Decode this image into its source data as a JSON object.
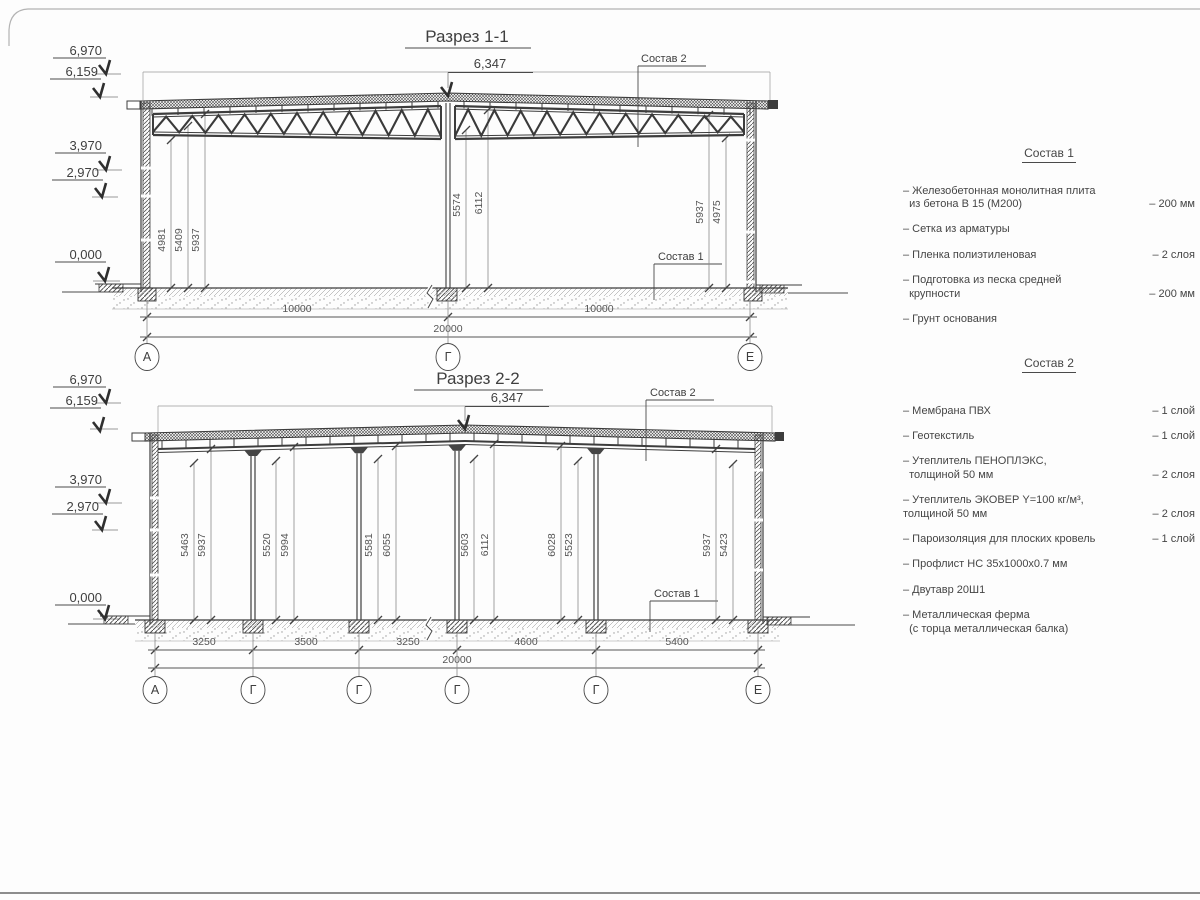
{
  "colors": {
    "line": "#3d3d3d",
    "thin_line": "#777777",
    "border": "#9a9a9a"
  },
  "drawing": {
    "s1": {
      "title": "Разрез 1-1",
      "ridge": "6,347",
      "elev": [
        "6,970",
        "6,159",
        "3,970",
        "2,970",
        "0,000"
      ],
      "sostav2_label": "Состав 2",
      "sostav1_label": "Состав 1",
      "vdims": [
        "4981",
        "5409",
        "5937",
        "5574",
        "6112",
        "5937",
        "4975"
      ],
      "span_dims": [
        "10000",
        "10000"
      ],
      "total_dim": "20000",
      "axes": [
        "А",
        "Г",
        "Е"
      ]
    },
    "s2": {
      "title": "Разрез 2-2",
      "ridge": "6,347",
      "elev": [
        "6,970",
        "6,159",
        "3,970",
        "2,970",
        "0,000"
      ],
      "sostav2_label": "Состав 2",
      "sostav1_label": "Состав 1",
      "vdims": [
        "5463",
        "5937",
        "5520",
        "5994",
        "5581",
        "6055",
        "5603",
        "6112",
        "6028",
        "5523",
        "5937",
        "5423"
      ],
      "span_dims": [
        "3250",
        "3500",
        "3250",
        "4600",
        "5400"
      ],
      "total_dim": "20000",
      "axes": [
        "А",
        "Г",
        "Г",
        "Г",
        "Г",
        "Е"
      ]
    }
  },
  "sostav1": {
    "heading": "Состав 1",
    "items": [
      {
        "text": "– Железобетонная  монолитная плита\n  из бетона В 15 (М200)",
        "value": "– 200 мм"
      },
      {
        "text": "– Сетка из арматуры",
        "value": ""
      },
      {
        "text": "– Пленка полиэтиленовая",
        "value": "–  2 слоя"
      },
      {
        "text": "– Подготовка из песка средней\n  крупности",
        "value": "– 200 мм"
      },
      {
        "text": "– Грунт основания",
        "value": ""
      }
    ]
  },
  "sostav2": {
    "heading": "Состав 2",
    "items": [
      {
        "text": "– Мембрана ПВХ",
        "value": "– 1 слой"
      },
      {
        "text": "– Геотекстиль",
        "value": "– 1 слой"
      },
      {
        "text": "– Утеплитель ПЕНОПЛЭКС,\n  толщиной 50 мм",
        "value": "– 2 слоя"
      },
      {
        "text": "– Утеплитель ЭКОВЕР Y=100 кг/м³,\nтолщиной 50 мм",
        "value": "– 2 слоя"
      },
      {
        "text": "– Пароизоляция для плоских кровель",
        "value": "– 1 слой"
      },
      {
        "text": "– Профлист НС 35х1000х0.7 мм",
        "value": ""
      },
      {
        "text": "– Двутавр 20Ш1",
        "value": ""
      },
      {
        "text": "– Металлическая ферма\n  (с торца металлическая балка)",
        "value": ""
      }
    ]
  }
}
